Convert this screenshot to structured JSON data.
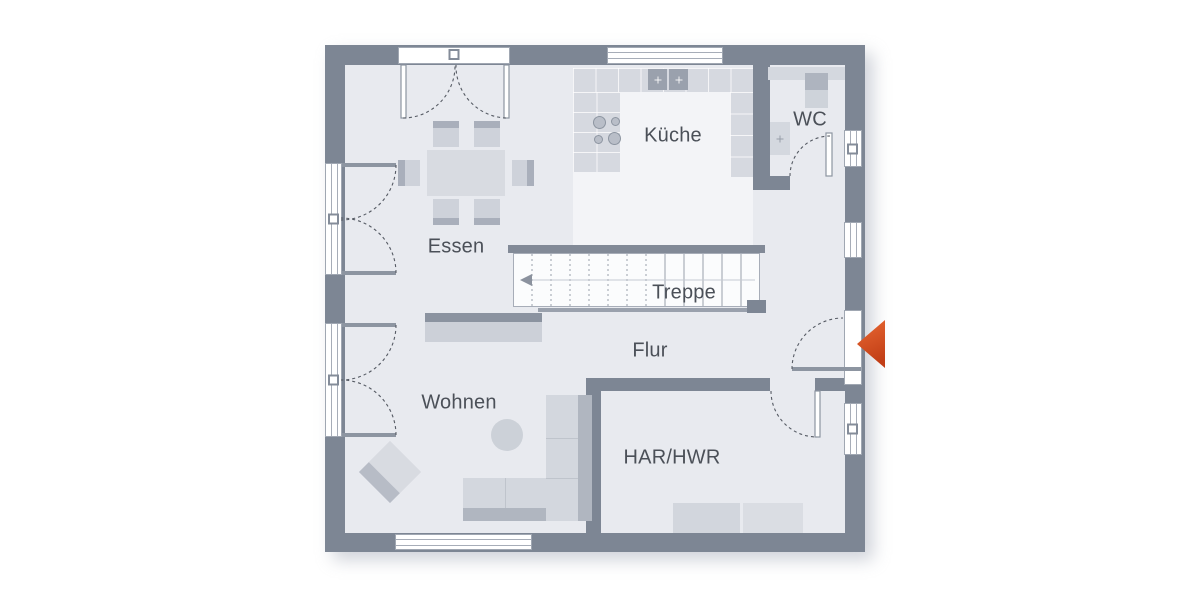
{
  "plan": {
    "rooms": [
      {
        "id": "kueche",
        "label": "Küche"
      },
      {
        "id": "wc",
        "label": "WC"
      },
      {
        "id": "essen",
        "label": "Essen"
      },
      {
        "id": "treppe",
        "label": "Treppe"
      },
      {
        "id": "flur",
        "label": "Flur"
      },
      {
        "id": "wohnen",
        "label": "Wohnen"
      },
      {
        "id": "har_hwr",
        "label": "HAR/HWR"
      }
    ],
    "colors": {
      "background": "#ffffff",
      "wall": "#7d8694",
      "floor": "#e8eaef",
      "kitchen_floor_highlight": "#f3f4f7",
      "furniture_light": "#d6d9e0",
      "furniture_dark": "#a9afbb",
      "appliance_dark": "#9aa1ad",
      "line": "#8d95a1",
      "text": "#4b5058",
      "entrance_arrow": "#d84b1f"
    },
    "icons": {
      "entrance_arrow": "left-pointing-triangle",
      "stairs_direction": "left-arrow"
    }
  }
}
